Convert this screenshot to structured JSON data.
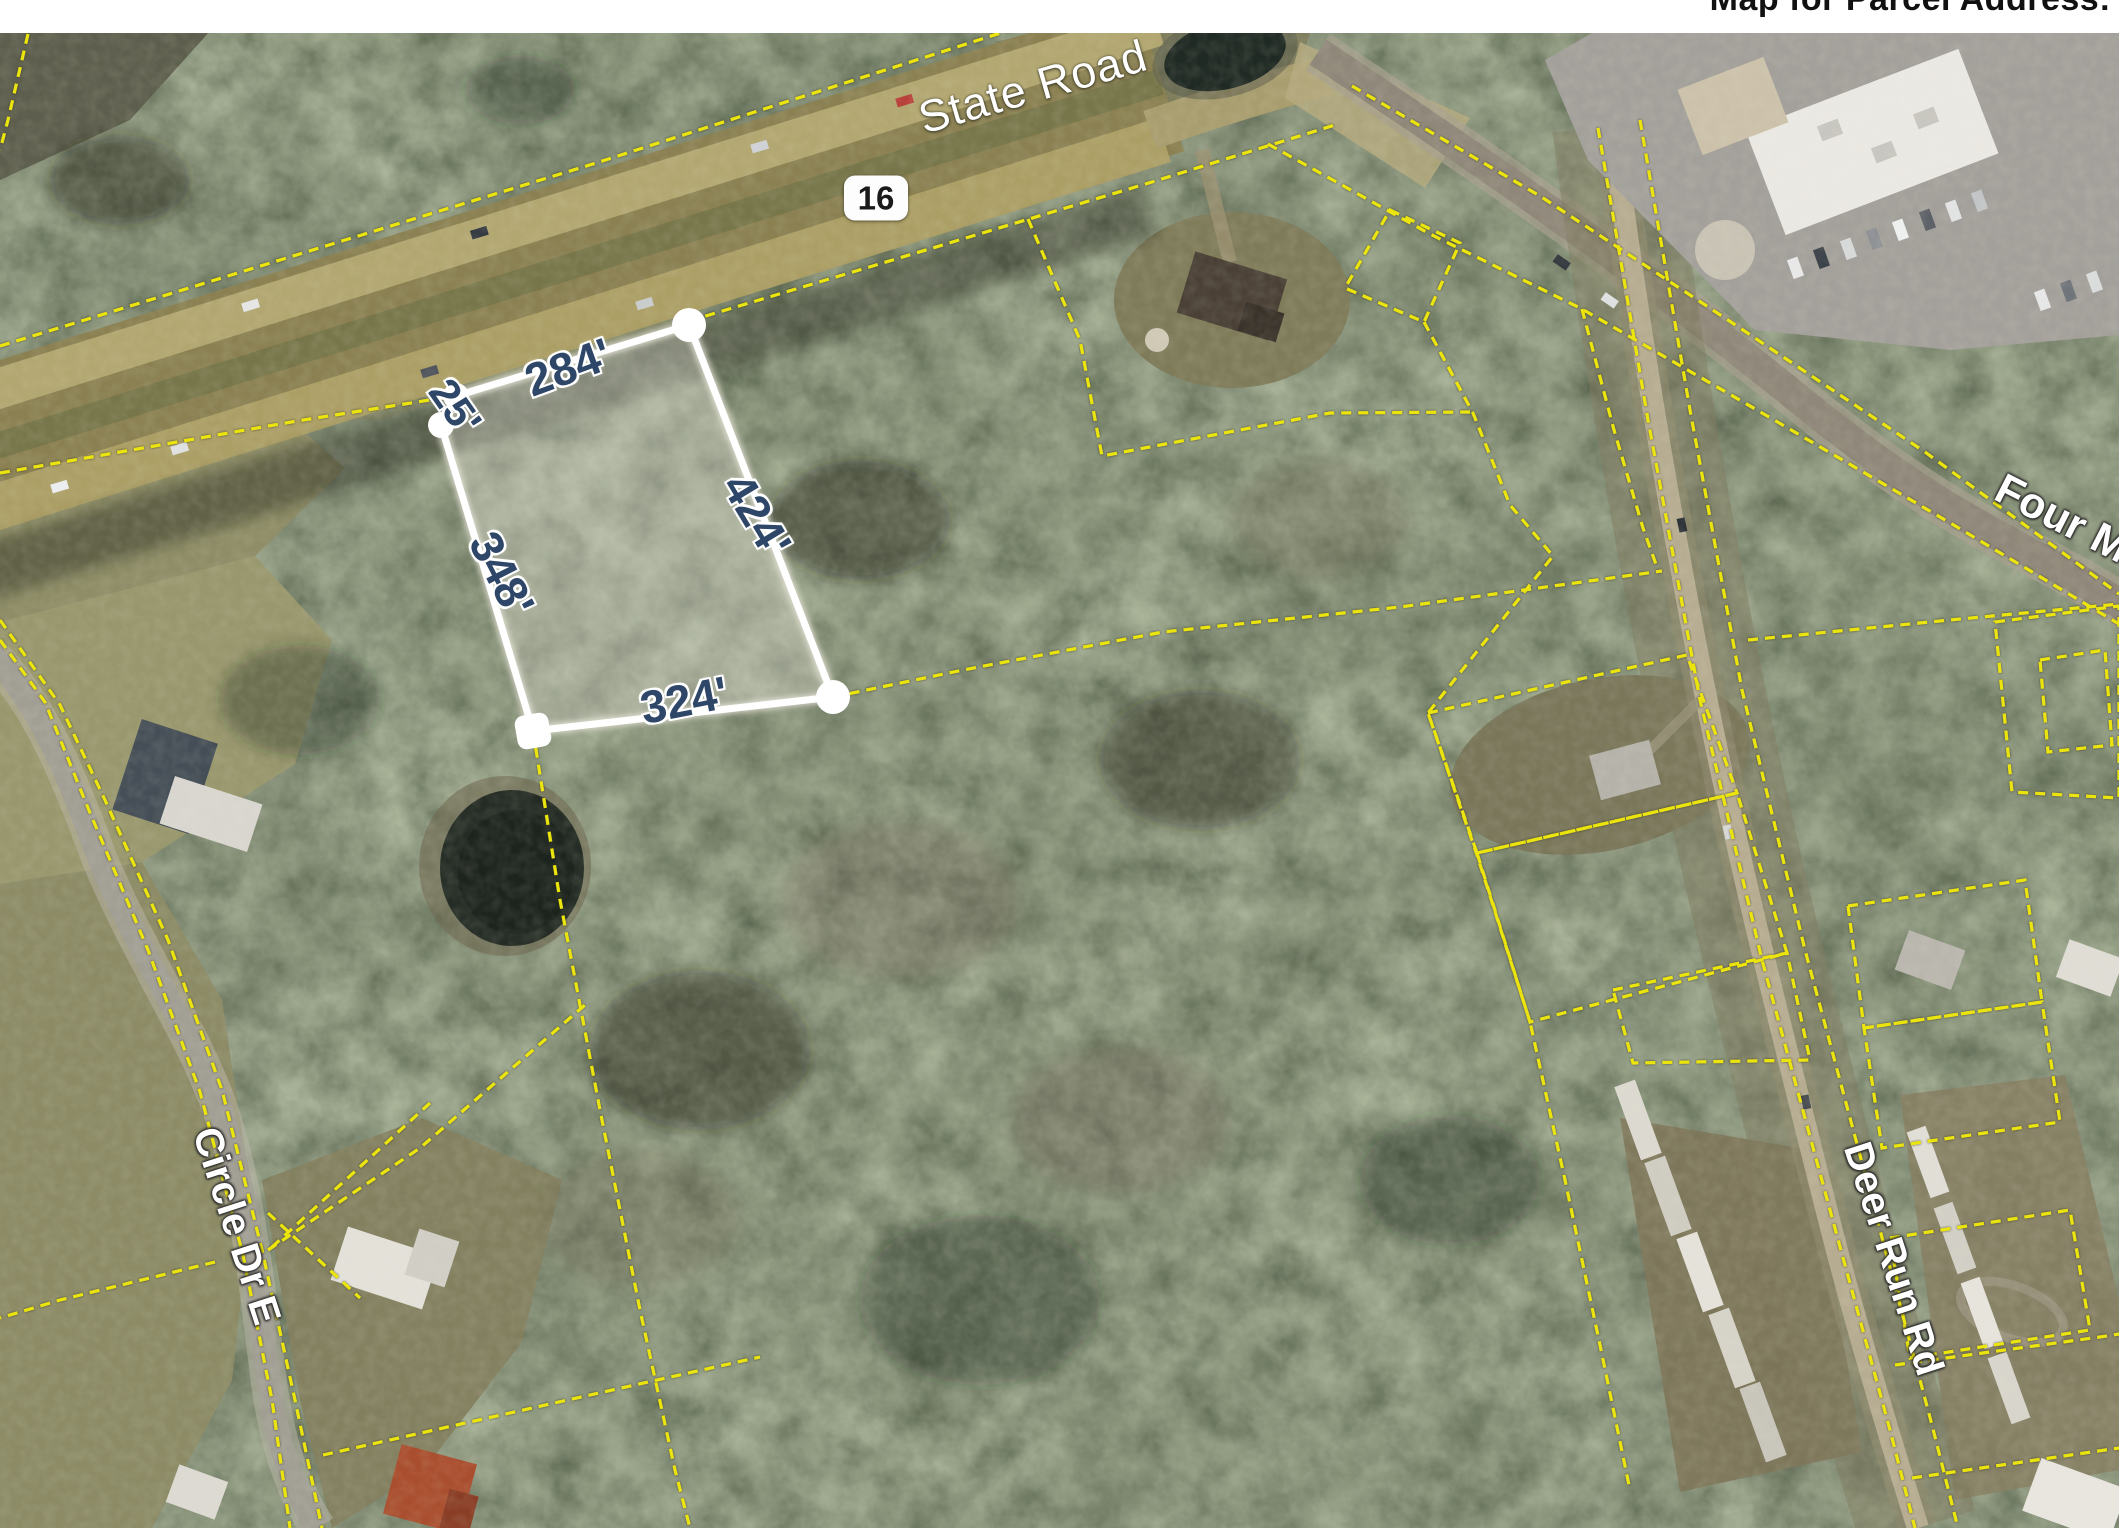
{
  "title": "Map for Parcel Address:",
  "route_shield": {
    "number": "16"
  },
  "road_labels": {
    "state_road": "State Road",
    "four_mile": "Four M",
    "circle_dr_e": "Circle Dr E",
    "deer_run_rd": "Deer Run Rd"
  },
  "parcel_measurements": {
    "top": "284'",
    "jog": "25'",
    "left": "348'",
    "right": "424'",
    "bottom": "324'"
  },
  "colors": {
    "boundary_yellow": "#ece40e",
    "parcel_outline": "#ffffff",
    "measurement_text": "#2e4668",
    "road_label_text": "#ffffff",
    "shield_text": "#1a1a1a",
    "title_text": "#111111"
  }
}
